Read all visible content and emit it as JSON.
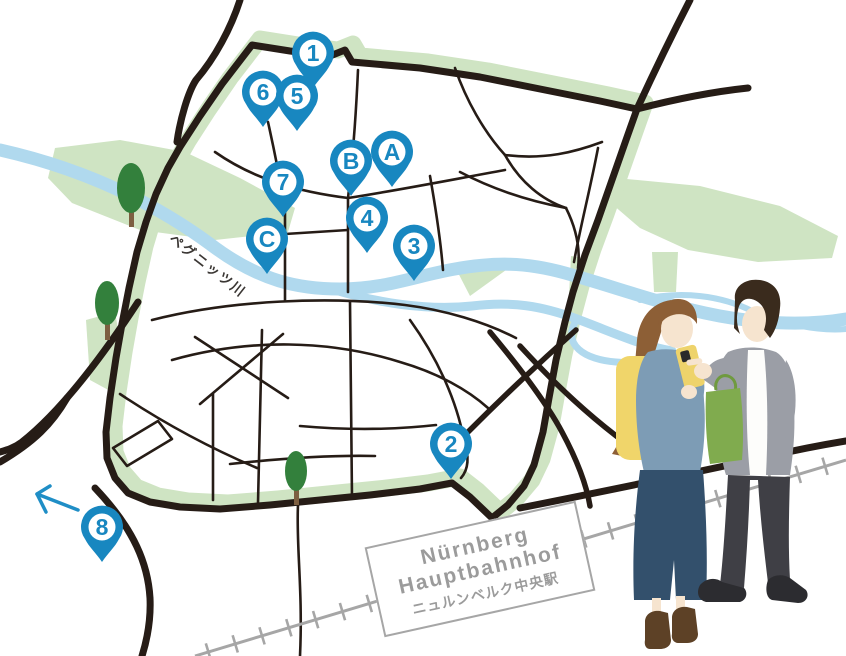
{
  "map": {
    "pins": [
      {
        "id": "1",
        "label": "1",
        "x": 313,
        "y": 53
      },
      {
        "id": "6",
        "label": "6",
        "x": 263,
        "y": 92
      },
      {
        "id": "5",
        "label": "5",
        "x": 297,
        "y": 96
      },
      {
        "id": "A",
        "label": "A",
        "x": 392,
        "y": 152
      },
      {
        "id": "B",
        "label": "B",
        "x": 351,
        "y": 161
      },
      {
        "id": "7",
        "label": "7",
        "x": 283,
        "y": 182
      },
      {
        "id": "4",
        "label": "4",
        "x": 367,
        "y": 218
      },
      {
        "id": "3",
        "label": "3",
        "x": 414,
        "y": 246
      },
      {
        "id": "C",
        "label": "C",
        "x": 267,
        "y": 239
      },
      {
        "id": "2",
        "label": "2",
        "x": 451,
        "y": 444
      },
      {
        "id": "8",
        "label": "8",
        "x": 102,
        "y": 527
      }
    ],
    "river_label": "ペグニッツ川",
    "station_label": {
      "line1": "Nürnberg",
      "line2": "Hauptbahnhof",
      "line3": "ニュルンベルク中央駅"
    }
  },
  "colors": {
    "pin": "#1887c0",
    "road": "#261c16",
    "wall": "#cfe4c3",
    "river": "#b0d9ee",
    "tree": "#33803c",
    "trunk": "#7d5f41",
    "rail": "#a6a6a6",
    "station_text": "#9b9b9b",
    "arrow": "#1f8ec6",
    "label_text": "#3b3734"
  }
}
